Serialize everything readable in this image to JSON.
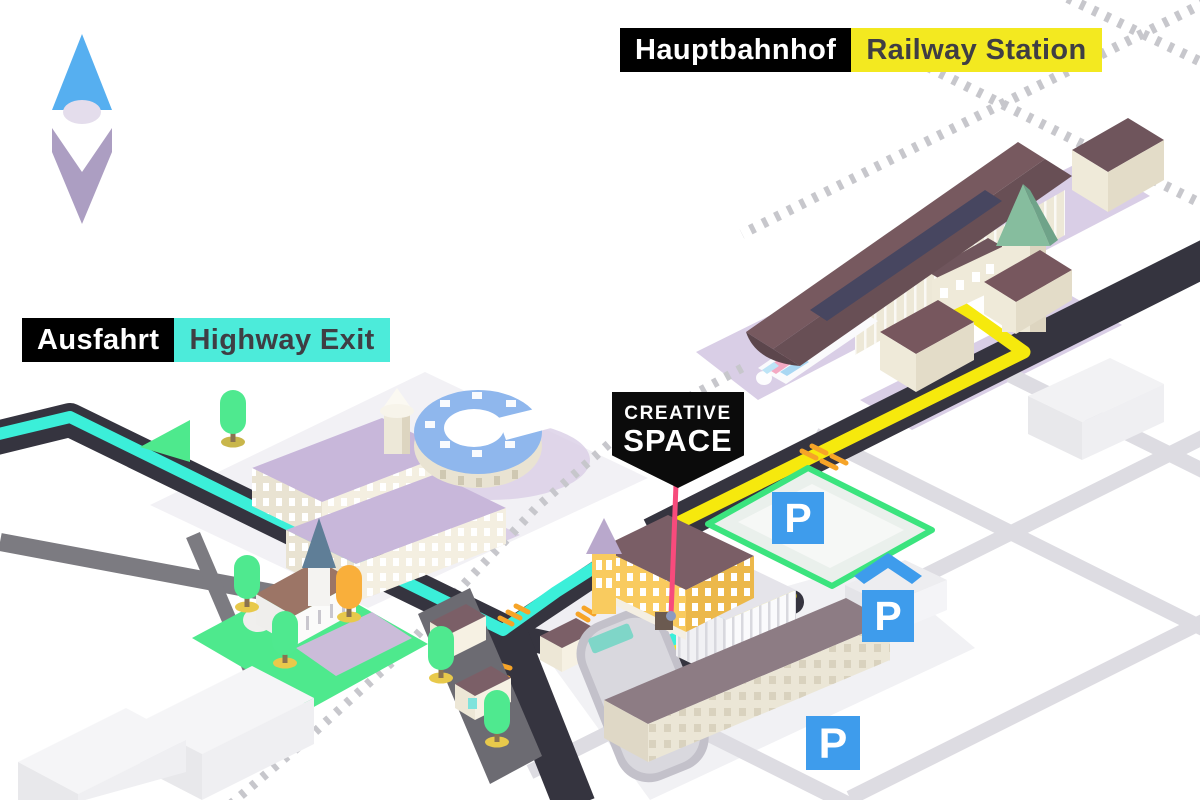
{
  "labels": {
    "station_de": "Hauptbahnhof",
    "station_en": "Railway Station",
    "highway_de": "Ausfahrt",
    "highway_en": "Highway Exit",
    "venue_line1": "CREATIVE",
    "venue_line2": "SPACE",
    "parking_symbol": "P"
  },
  "markers": {
    "parking": [
      {
        "name": "surface-lot-near-venue",
        "symbol": "P"
      },
      {
        "name": "covered-parking-garage",
        "symbol": "P"
      },
      {
        "name": "surface-lot-south",
        "symbol": "P"
      }
    ],
    "compass": {
      "direction": "north"
    }
  },
  "routes": [
    {
      "name": "route-from-railway-station",
      "color": "#F6E90D",
      "from": "Hauptbahnhof / Railway Station",
      "to": "CREATIVE SPACE"
    },
    {
      "name": "route-from-highway-exit",
      "color": "#3BEFD9",
      "from": "Ausfahrt / Highway Exit",
      "to": "CREATIVE SPACE"
    }
  ],
  "colors": {
    "route_yellow": "#F6E90D",
    "route_cyan": "#3BEFD9",
    "label_yellow_bg": "#F3E920",
    "label_cyan_bg": "#4CEBDA",
    "label_black_bg": "#000000",
    "label_dark_text": "#3F3E44",
    "road_dark": "#35343F",
    "road_minor": "#DDDCE2",
    "road_gray": "#7C7B81",
    "railway_dash": "#C7C7CC",
    "pointer_pink": "#F74B7C",
    "parking_blue": "#3E9CEC",
    "lawn_green": "#4EE98D",
    "lot_border_green": "#3BE47E",
    "compass_blue": "#56AFF0",
    "compass_purple": "#AC9EC2",
    "station_roof": "#6D545B",
    "building_cream": "#EFEAD9",
    "roof_lavender": "#C8B7DA",
    "venue_wall_yellow": "#F9CB5F",
    "round_building_blue": "#8FB7ED"
  }
}
